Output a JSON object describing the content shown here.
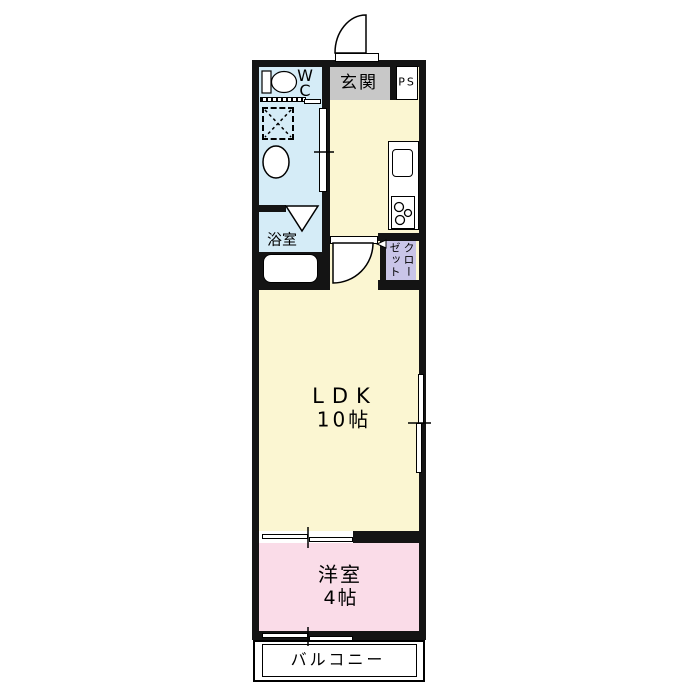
{
  "colors": {
    "bg": "#ffffff",
    "wall": "#141414",
    "water_blue": "#d5ecf7",
    "room_yellow": "#fbf6d2",
    "room_pink": "#fadce8",
    "closet_purple": "#c9c5e8",
    "genkan_gray": "#c8c8c8",
    "line": "#000000"
  },
  "labels": {
    "wc": "W\nC",
    "genkan": "玄関",
    "ps": "PS",
    "bathroom": "浴室",
    "closet": "クローゼット",
    "ldk_name": "LDK",
    "ldk_size": "10帖",
    "bedroom_name": "洋室",
    "bedroom_size": "4帖",
    "balcony": "バルコニー"
  },
  "icons": [
    "toilet-icon",
    "washing-machine-icon",
    "washbasin-icon",
    "bathtub-icon",
    "folding-door-icon",
    "kitchen-sink-icon",
    "stove-icon",
    "entrance-door-arc-icon",
    "room-door-arc-icon",
    "sliding-door-icon",
    "sliding-window-icon"
  ]
}
